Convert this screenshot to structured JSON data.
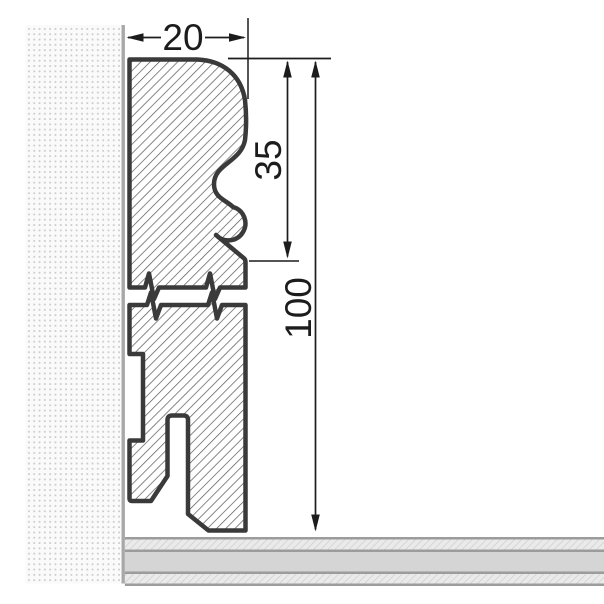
{
  "drawing": {
    "dimensions": {
      "width": {
        "label": "20"
      },
      "profile_height": {
        "label": "35"
      },
      "total_height": {
        "label": "100"
      }
    },
    "colors": {
      "board_outline": "#3a3a3a",
      "board_hatch_line": "#555555",
      "dimension_ink": "#1c1c1c",
      "wall_dot": "#c8c8c8",
      "wall_background": "#fafafa",
      "wall_face_line": "#a8a8a8",
      "floor_layer_border": "#9c9c9c",
      "floor_middle_layer": "#d5d5d5",
      "floor_hatch_background": "#eaeaea",
      "floor_hatch_line": "#c9c9c9"
    }
  }
}
